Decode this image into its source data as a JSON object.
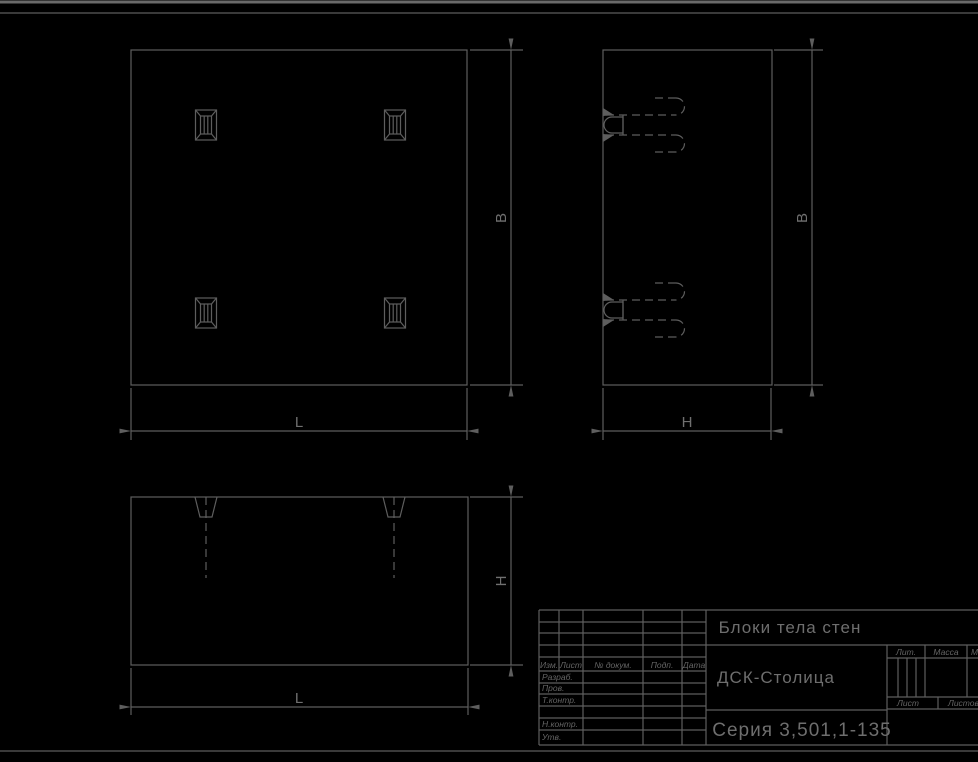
{
  "sheet": {
    "title": "Блоки тела стен",
    "organization": "ДСК-Столица",
    "series": "Серия 3,501,1-135"
  },
  "dimension_labels": {
    "plan_width": "B",
    "plan_length": "L",
    "side_width": "B",
    "side_height": "H",
    "front_height": "H",
    "front_length": "L"
  },
  "title_block": {
    "revision_columns": [
      "Изм.",
      "Лист",
      "№ докум.",
      "Подп.",
      "Дата"
    ],
    "signature_rows": [
      "Разраб.",
      "Пров.",
      "Т.контр.",
      "Н.контр.",
      "Утв."
    ],
    "lit_label": "Лит.",
    "mass_label": "Масса",
    "scale_label": "Масштаб",
    "sheet_label": "Лист",
    "sheets_label": "Листов"
  },
  "colors": {
    "background": "#000000",
    "line": "#5e5e5e",
    "text": "#6e6e6e"
  }
}
